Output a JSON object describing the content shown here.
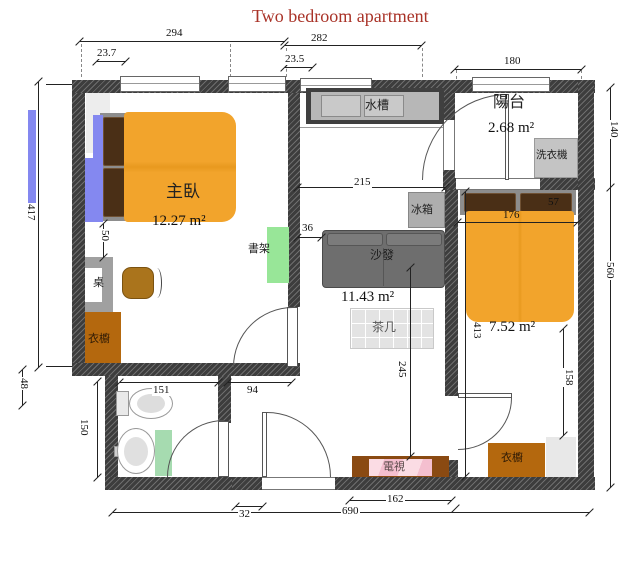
{
  "title": "Two bedroom apartment",
  "colors": {
    "title": "#a93328",
    "wall": "#3d3d3d",
    "hatch": "#6e6e6e",
    "bed": "#f2a42c",
    "pillow": "#4a2f16",
    "frame": "#8d8d8d",
    "wardrobe": "#b4680e",
    "chair": "#aa741c",
    "sofa": "#6e6e6e",
    "cushion": "#7b7b7b",
    "greenShelf": "#98e698",
    "greenMat": "#a6dbb0",
    "blue": "#8488f0",
    "tvcab": "#8a4a12",
    "counter": "#b7b7b7",
    "appliance": "#b5b5b5"
  },
  "rooms": {
    "master": {
      "name": "主臥",
      "area": "12.27 m²"
    },
    "living": {
      "area": "11.43 m²"
    },
    "balcony": {
      "name": "陽台",
      "area": "2.68 m²"
    },
    "bedroom2": {
      "area": "7.52 m²"
    }
  },
  "furniture": {
    "sink": "水槽",
    "washer": "洗衣機",
    "fridge": "冰箱",
    "sofa": "沙發",
    "coffee_table": "茶几",
    "tv": "電視",
    "bookshelf": "書架",
    "desk": "桌",
    "wardrobe_master": "衣櫥",
    "wardrobe_bedroom2": "衣櫥"
  },
  "dims": {
    "d294": "294",
    "d282": "282",
    "d237": "23.7",
    "d235": "23.5",
    "d180": "180",
    "d417": "417",
    "d48": "48",
    "d150": "150",
    "d50": "50",
    "d151": "151",
    "d94": "94",
    "d32": "32",
    "d215": "215",
    "d36": "36",
    "d245": "245",
    "d162": "162",
    "d690": "690",
    "d176": "176",
    "d57": "57",
    "d413": "413",
    "d158": "158",
    "d140": "140",
    "d560": "560"
  }
}
